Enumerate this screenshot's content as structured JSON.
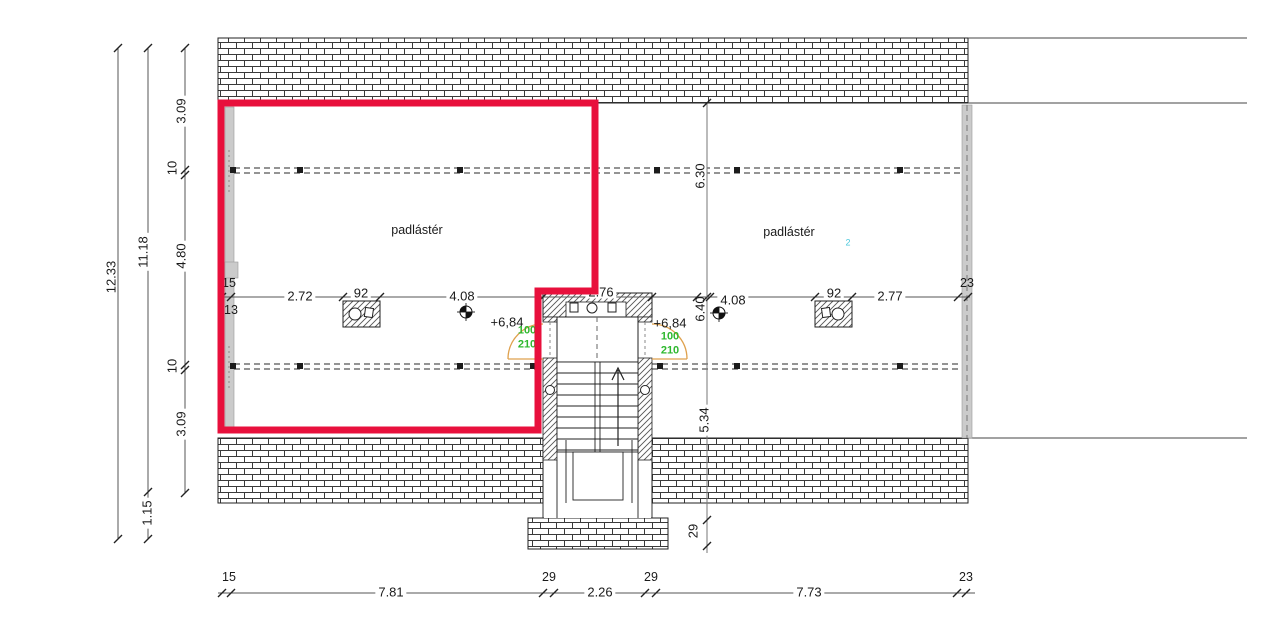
{
  "rooms": {
    "left_label": "padlástér",
    "right_label": "padlástér",
    "right_index": "2"
  },
  "levels": {
    "left": "+6,84",
    "right": "+6,84"
  },
  "doors": {
    "left_width": "100",
    "left_height": "210",
    "right_width": "100",
    "right_height": "210"
  },
  "dims": {
    "total_height": "12.33",
    "inner_height": "11.18",
    "eave": "1.15",
    "v1": "3.09",
    "v2": "10",
    "v3": "4.80",
    "v4": "10",
    "v5": "3.09",
    "wall_left_a": "15",
    "wall_left_b": "13",
    "h1": "2.72",
    "chimney_left": "92",
    "h2": "4.08",
    "stair_width": "2.76",
    "axis_top": "6.30",
    "axis_mid": "6.40",
    "axis_low": "5.34",
    "axis_wall": "29",
    "h3": "4.08",
    "chimney_right": "92",
    "h4": "2.77",
    "wall_right": "23",
    "b_w1": "15",
    "b1": "7.81",
    "b_w2": "29",
    "b2": "2.26",
    "b_w3": "29",
    "b3": "7.73",
    "b_w4": "23"
  },
  "colors": {
    "highlight": "#e8103c",
    "door_swing": "#dfa14d",
    "opening_text": "#2eb82e",
    "wall_section": "#cbcbcb",
    "axis_note": "#4cc8dc"
  }
}
